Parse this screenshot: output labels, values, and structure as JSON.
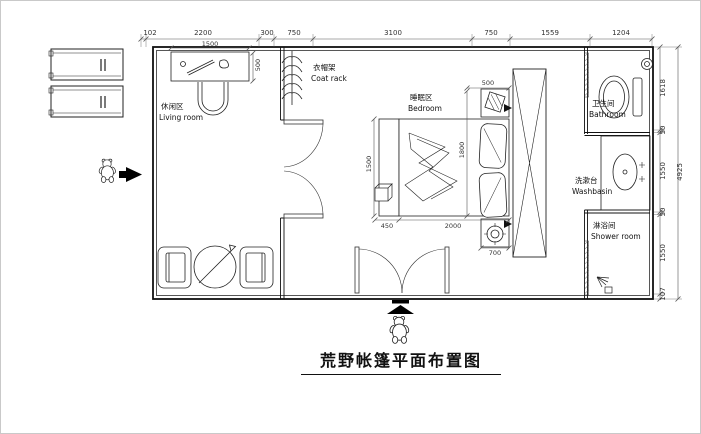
{
  "title": "荒野帐篷平面布置图",
  "rooms": {
    "living": {
      "zh": "休闲区",
      "en": "Living room"
    },
    "coat": {
      "zh": "衣帽架",
      "en": "Coat rack"
    },
    "bedroom": {
      "zh": "睡眠区",
      "en": "Bedroom"
    },
    "bathroom": {
      "zh": "卫生间",
      "en": "Bathroom"
    },
    "washbasin": {
      "zh": "洗漱台",
      "en": "Washbasin"
    },
    "shower": {
      "zh": "淋浴间",
      "en": "Shower room"
    }
  },
  "dimensions": {
    "top": [
      "102",
      "2200",
      "300",
      "750",
      "3100",
      "750",
      "1559",
      "1204"
    ],
    "right": [
      "1618",
      "50",
      "1550",
      "50",
      "1550",
      "107"
    ],
    "right_total": "4925",
    "interior": {
      "desk_width": "1500",
      "desk_depth": "500",
      "bench_length": "1500",
      "bed_length": "1800",
      "bench_width": "450",
      "bed_width": "2000",
      "nightstand_top": "500",
      "nightstand_bottom": "700"
    }
  },
  "colors": {
    "ink": "#1a1a1a",
    "dimension_lines": "#555555",
    "background": "#ffffff"
  }
}
